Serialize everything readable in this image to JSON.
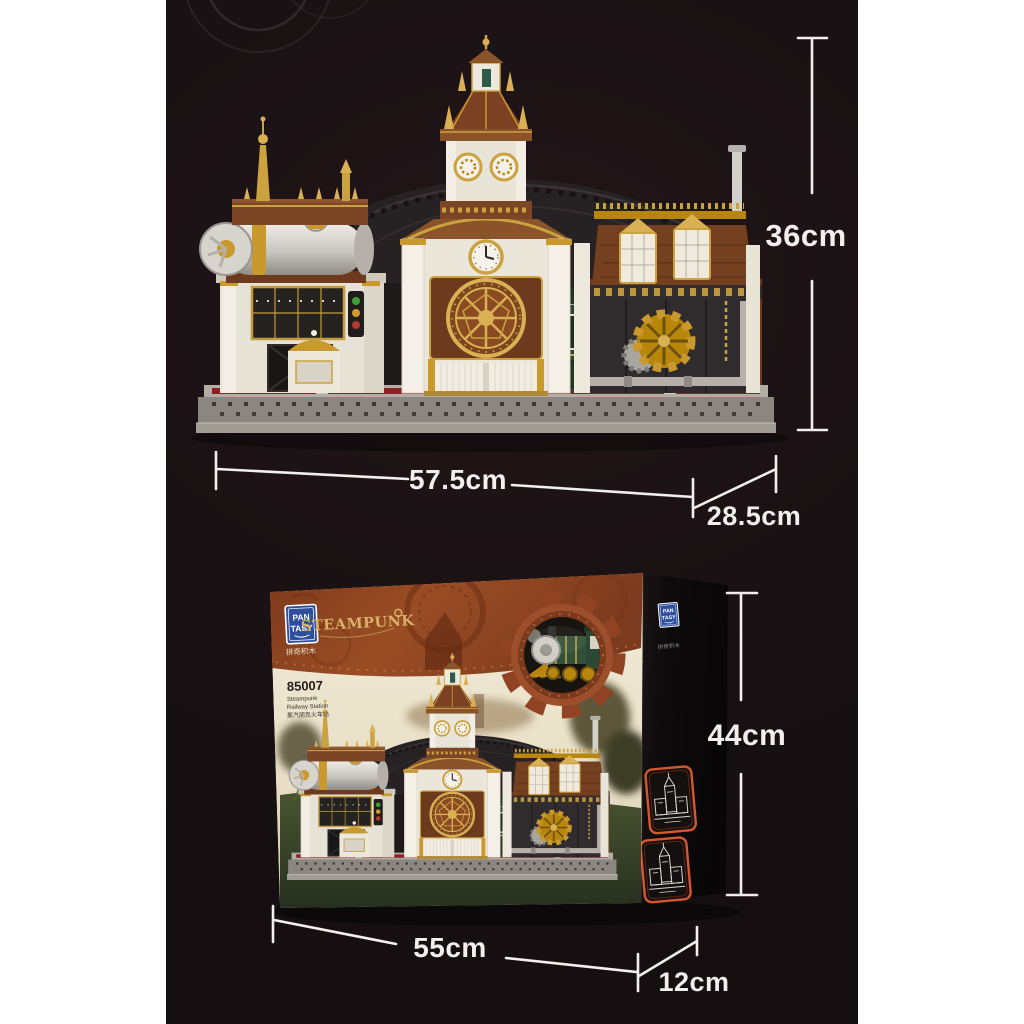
{
  "page": {
    "background": "#ffffff",
    "photo_panel_background": "#1a1114"
  },
  "product": {
    "brand": "PANTASY",
    "series": "STEAMPUNK",
    "sku": "85007",
    "name": "Steampunk Railway Station",
    "subject": "steampunk railway-station building-block model: central clock tower, steam-boiler left wing, gear wall right wing, green tram kiosk, dark arched train-shed roof, gray stud base"
  },
  "dimension_callouts": {
    "model": {
      "height": "36cm",
      "width": "57.5cm",
      "depth": "28.5cm"
    },
    "box": {
      "height": "44cm",
      "width": "55cm",
      "depth": "12cm"
    }
  },
  "box": {
    "front": {
      "brand_line1": "PAN",
      "brand_line2": "TASY",
      "brand_cn": "拼奇积木",
      "series_title": "STEAMPUNK",
      "sku": "85007",
      "name_line1": "Steampunk",
      "name_line2": "Railway Station",
      "name_cn": "蒸汽朋克火车站"
    },
    "side": {
      "thumbnails": "two orange-framed line-art views of the station"
    }
  },
  "icons": {
    "gear_medallion": "gear-icon framing a steampunk locomotive",
    "smoke_rings": "faint concentric smoke-ring arcs at top left"
  },
  "colors": {
    "dimension_lines": "#f2efec",
    "band_rust": "#94431f",
    "steampunk_gold": "#d9b166",
    "brand_blue": "#2e4f9e",
    "box_cream": "#efe7d2",
    "side_panel_black": "#0d0a0b",
    "thumbnail_border": "#d4582e",
    "model_brown": "#7a4426",
    "model_gold": "#c9992e",
    "model_cream": "#ebe6da",
    "roof_charcoal": "#262122",
    "tram_green": "#2c4430",
    "base_gray": "#8b8780",
    "stripe_red": "#8e2126"
  }
}
